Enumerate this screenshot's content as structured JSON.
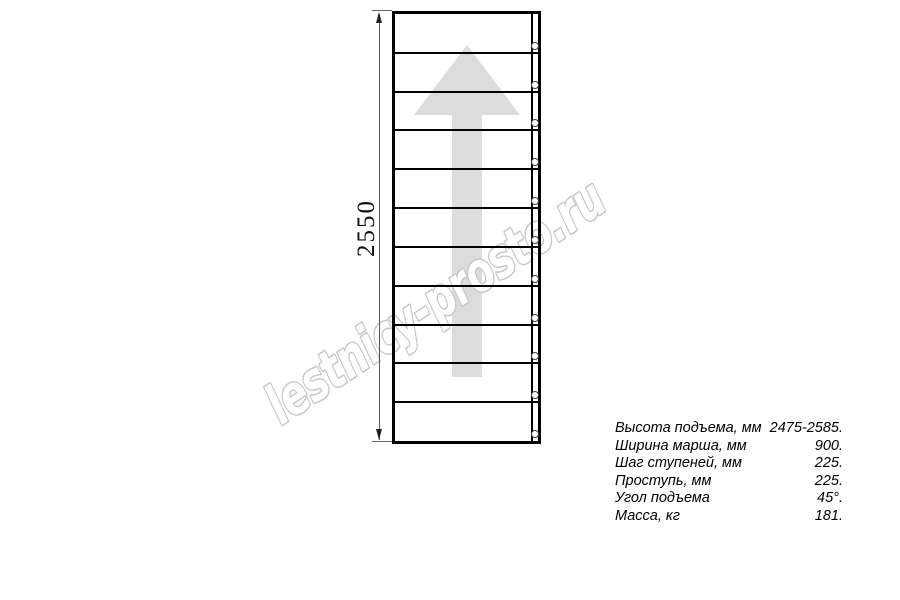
{
  "watermark": {
    "text": "lestnicy-prosto.ru"
  },
  "diagram": {
    "dimension_label": "2550",
    "step_count": 11,
    "colors": {
      "line": "#000000",
      "dim_line": "#555555",
      "watermark_stroke": "#c6c6c6",
      "arrow_fill": "#dcdcdc"
    }
  },
  "specs": {
    "rows": [
      {
        "label": "Высота подъема, мм",
        "value": "2475-2585."
      },
      {
        "label": "Ширина марша, мм",
        "value": "900."
      },
      {
        "label": "Шаг ступеней, мм",
        "value": "225."
      },
      {
        "label": "Проступь, мм",
        "value": "225."
      },
      {
        "label": "Угол подъема",
        "value": "45°."
      },
      {
        "label": "Масса, кг",
        "value": "181."
      }
    ]
  }
}
